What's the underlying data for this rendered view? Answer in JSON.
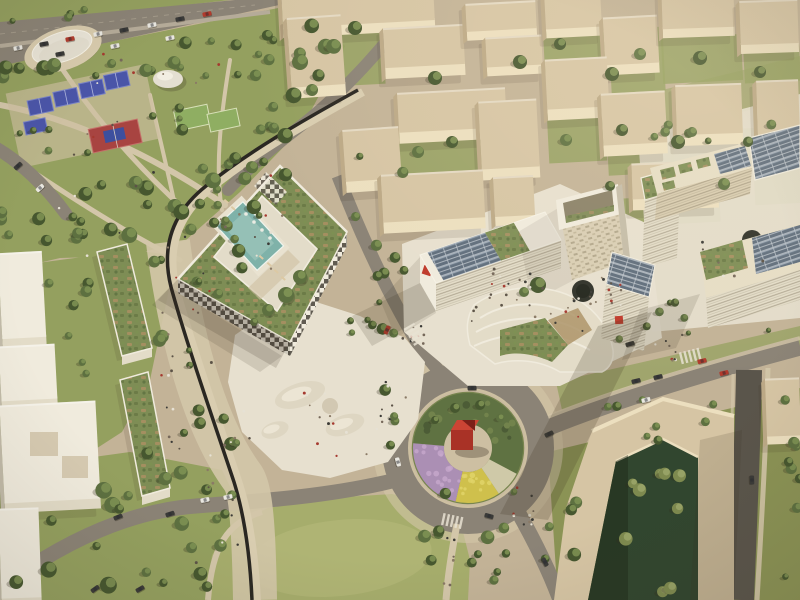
{
  "scene": {
    "type": "aerial-architectural-rendering",
    "setting": "Bird's-eye architectural visualization of a mixed-use urban masterplan district in warm afternoon light",
    "visible_text": [],
    "palette": {
      "groundSand": "#c3b397",
      "parkGrass": "#94a05f",
      "parkGrassLight": "#aeb272",
      "fieldGreen": "#8fae62",
      "lawnGreen": "#a6ad6c",
      "lawnLight": "#b7b97c",
      "treeDark": "#46572f",
      "treeMid": "#5d7040",
      "treeLight": "#7d9153",
      "oliveTree": "#7e8a4f",
      "roadAsphalt": "#8b8376",
      "roadDark": "#5a554b",
      "sidewalk": "#d3c6a9",
      "plazaWhite": "#e7e0cf",
      "beigeRoof": "#d6c5a4",
      "beigeLit": "#ecdfbf",
      "beigeShade": "#bca986",
      "whiteRoof": "#f0ebdd",
      "whiteLit": "#e3dcc8",
      "whiteShade": "#c2bba9",
      "checkerDark": "#504b42",
      "greenRoof": "#7e8d55",
      "greenRoofBrown": "#a98f62",
      "greenRoofDark": "#6c7b47",
      "poolTeal": "#7fb2a9",
      "poolLight": "#a3c9bf",
      "solarPanel": "#5f6d7c",
      "solarLine": "#c2c9d0",
      "accentRed": "#bf3a2b",
      "sculptureRedDark": "#a93226",
      "sculptureRedTop": "#cc4434",
      "courtBlue": "#4a55a8",
      "courtRed": "#a84441",
      "courtInnerBlue": "#3d4f9e",
      "flowerPurple": "#ab8fb4",
      "flowerYellow": "#cfc04c",
      "flowerPale": "#cfc9a8",
      "domeWhite": "#e9e4d7",
      "darkCourt": "#31462f",
      "blackPath": "#2a2722",
      "carWhite": "#e9e7e0",
      "carDark": "#3a3a38",
      "carRed": "#b23a2c",
      "hedgeDark": "#4a5632",
      "pondDark": "#2f3129",
      "shadow": "rgba(60,50,35,0.25)"
    },
    "features": {
      "highway": {
        "label": "highway with traffic along the top-left edge",
        "lanes": 2
      },
      "park": {
        "label": "public park with sports facilities",
        "items": [
          "event-canopy-disc",
          "dome-pavilion",
          "tennis-courts",
          "basketball-court",
          "sports-fields",
          "tree-groves",
          "footpaths"
        ],
        "court_colors": {
          "tennis": "#4a55a8",
          "basketball": "#a84441",
          "field": "#8fae62"
        }
      },
      "courtyard_hotel": {
        "label": "white courtyard building with checkerboard facade, roof gardens and rooftop pool",
        "pool_color": "#7fb2a9"
      },
      "residential_blocks": {
        "label": "beige massing blocks with green courtyards",
        "count": 19
      },
      "campus_cluster": {
        "label": "white mixed-use cluster with public plaza",
        "items": [
          "solar-roof slab with red logo",
          "portal-frame tower",
          "curved terraced building with roof gardens",
          "solar-roof building with red logo",
          "sunken circular pond",
          "crowded plaza"
        ],
        "logo_color": "#bf3a2b"
      },
      "east_cluster": {
        "label": "office buildings with photovoltaic and planted roofs",
        "items": [
          "solar roofs",
          "green roofs",
          "circular courtyard pond"
        ]
      },
      "roundabout": {
        "label": "landscaped roundabout",
        "sculpture": "red cube sculpture on paved center",
        "planting_colors": [
          "#ab8fb4",
          "#cfc04c",
          "#5f7242"
        ]
      },
      "linear_park": {
        "label": "green boulevard with dark cycle path and green-roof housing slabs"
      },
      "chevron_building": {
        "label": "beige chevron-shaped block enclosing a dark green tree courtyard"
      },
      "lawn": {
        "label": "open oval lawn at bottom center"
      },
      "vehicles": {
        "label": "cars on streets and roundabout",
        "colors": [
          "#e9e7e0",
          "#3a3a38",
          "#b23a2c"
        ],
        "count": 30
      },
      "pedestrians": {
        "label": "crowds of tiny figures in plazas, park, boulevard and crossings"
      }
    }
  }
}
